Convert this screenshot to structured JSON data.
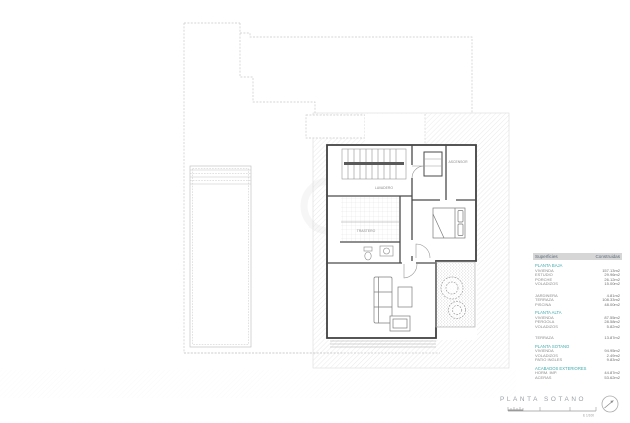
{
  "title_block": {
    "title": "PLANTA SOTANO",
    "scale_text": "E 1/100"
  },
  "plan": {
    "labels": {
      "laundry": "LAVADERO",
      "storage": "TRASTERO",
      "elevator": "ASCENSOR"
    }
  },
  "colors": {
    "accent_teal": "#3fa9ac",
    "table_header_bg": "#d6d6d6",
    "wall": "#3f3f3f",
    "boundary": "#c9c9c9"
  },
  "table": {
    "header": [
      "Superficies",
      "Construidas"
    ],
    "rows": [
      {
        "type": "section",
        "label": "PLANTA BAJA",
        "value": ""
      },
      {
        "type": "item",
        "label": "VIVIENDA",
        "value": "157.13m2"
      },
      {
        "type": "item",
        "label": "ESTUDIO",
        "value": "29.96m2"
      },
      {
        "type": "item",
        "label": "PORCHE",
        "value": "26.12m2"
      },
      {
        "type": "item",
        "label": "VOLADIZOS",
        "value": "15.00m2"
      },
      {
        "type": "gap",
        "label": "",
        "value": ""
      },
      {
        "type": "item",
        "label": "JARDINERA",
        "value": "4.81m2"
      },
      {
        "type": "item",
        "label": "TERRAZA",
        "value": "108.33m2"
      },
      {
        "type": "item",
        "label": "PISCINA",
        "value": "48.00m2"
      },
      {
        "type": "section",
        "label": "PLANTA ALTA",
        "value": ""
      },
      {
        "type": "item",
        "label": "VIVIENDA",
        "value": "87.55m2"
      },
      {
        "type": "item",
        "label": "PERGOLA",
        "value": "28.58m2"
      },
      {
        "type": "item",
        "label": "VOLADIZOS",
        "value": "5.82m2"
      },
      {
        "type": "gap",
        "label": "",
        "value": ""
      },
      {
        "type": "item",
        "label": "TERRAZA",
        "value": "13.87m2"
      },
      {
        "type": "section",
        "label": "PLANTA SOTANO",
        "value": ""
      },
      {
        "type": "item",
        "label": "VIVIENDA",
        "value": "94.95m2"
      },
      {
        "type": "item",
        "label": "VOLADIZOS",
        "value": "2.49m2"
      },
      {
        "type": "item",
        "label": "PATIO INGLES",
        "value": "9.83m2"
      },
      {
        "type": "section",
        "label": "ACABADOS EXTERIORES",
        "value": ""
      },
      {
        "type": "item",
        "label": "HORM. IMP.",
        "value": "44.87m2"
      },
      {
        "type": "item",
        "label": "ACERAS",
        "value": "53.62m2"
      }
    ]
  }
}
